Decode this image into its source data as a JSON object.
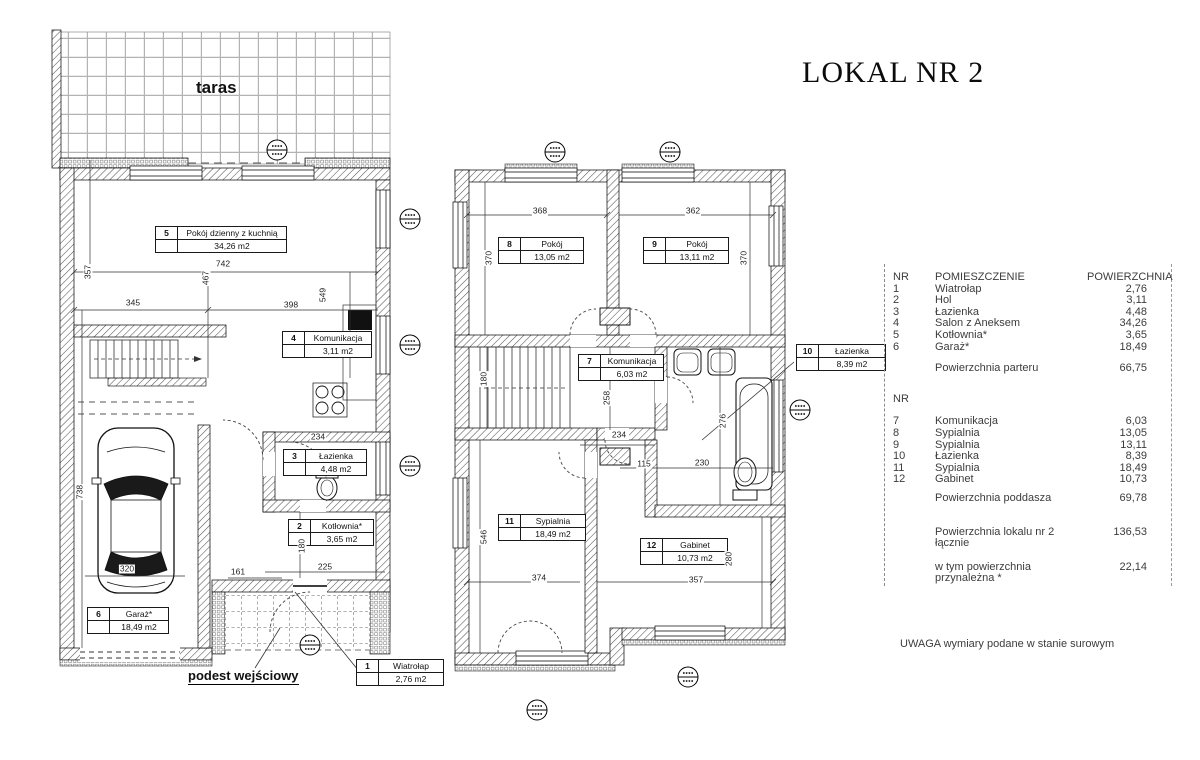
{
  "title": "LOKAL NR 2",
  "left_plan": {
    "terrace_label": "taras",
    "entry_label": "podest wejściowy",
    "rooms": [
      {
        "nr": "5",
        "name": "Pokój dzienny z kuchnią",
        "area": "34,26 m2",
        "x": 155,
        "y": 226,
        "w": 130
      },
      {
        "nr": "4",
        "name": "Komunikacja",
        "area": "3,11 m2",
        "x": 282,
        "y": 331,
        "w": 88
      },
      {
        "nr": "3",
        "name": "Łazienka",
        "area": "4,48 m2",
        "x": 283,
        "y": 449,
        "w": 82
      },
      {
        "nr": "2",
        "name": "Kotłownia*",
        "area": "3,65 m2",
        "x": 288,
        "y": 519,
        "w": 84
      },
      {
        "nr": "6",
        "name": "Garaż*",
        "area": "18,49 m2",
        "x": 87,
        "y": 607,
        "w": 80
      },
      {
        "nr": "1",
        "name": "Wiatrołap",
        "area": "2,76 m2",
        "x": 356,
        "y": 659,
        "w": 86
      }
    ],
    "dimensions": [
      {
        "v": "357",
        "x": 88,
        "y": 272,
        "rot": true
      },
      {
        "v": "742",
        "x": 223,
        "y": 264
      },
      {
        "v": "467",
        "x": 206,
        "y": 278,
        "rot": true
      },
      {
        "v": "345",
        "x": 133,
        "y": 303
      },
      {
        "v": "398",
        "x": 291,
        "y": 305
      },
      {
        "v": "549",
        "x": 323,
        "y": 295,
        "rot": true
      },
      {
        "v": "738",
        "x": 80,
        "y": 492,
        "rot": true
      },
      {
        "v": "320",
        "x": 127,
        "y": 569
      },
      {
        "v": "161",
        "x": 238,
        "y": 572
      },
      {
        "v": "225",
        "x": 325,
        "y": 567
      },
      {
        "v": "180",
        "x": 302,
        "y": 546,
        "rot": true
      },
      {
        "v": "234",
        "x": 318,
        "y": 437
      }
    ],
    "markers": [
      {
        "x": 277,
        "y": 150
      },
      {
        "x": 410,
        "y": 219
      },
      {
        "x": 410,
        "y": 345
      },
      {
        "x": 410,
        "y": 466
      },
      {
        "x": 310,
        "y": 645
      }
    ]
  },
  "right_plan": {
    "rooms": [
      {
        "nr": "8",
        "name": "Pokój",
        "area": "13,05 m2",
        "x": 498,
        "y": 237,
        "w": 84
      },
      {
        "nr": "9",
        "name": "Pokój",
        "area": "13,11 m2",
        "x": 643,
        "y": 237,
        "w": 84
      },
      {
        "nr": "7",
        "name": "Komunikacja",
        "area": "6,03 m2",
        "x": 578,
        "y": 354,
        "w": 84
      },
      {
        "nr": "10",
        "name": "Łazienka",
        "area": "8,39 m2",
        "x": 796,
        "y": 344,
        "w": 88
      },
      {
        "nr": "11",
        "name": "Sypialnia",
        "area": "18,49 m2",
        "x": 498,
        "y": 514,
        "w": 86
      },
      {
        "nr": "12",
        "name": "Gabinet",
        "area": "10,73 m2",
        "x": 640,
        "y": 538,
        "w": 86
      }
    ],
    "dimensions": [
      {
        "v": "368",
        "x": 540,
        "y": 211
      },
      {
        "v": "362",
        "x": 693,
        "y": 211
      },
      {
        "v": "370",
        "x": 489,
        "y": 258,
        "rot": true
      },
      {
        "v": "370",
        "x": 744,
        "y": 258,
        "rot": true
      },
      {
        "v": "180",
        "x": 484,
        "y": 379,
        "rot": true
      },
      {
        "v": "258",
        "x": 607,
        "y": 398,
        "rot": true
      },
      {
        "v": "234",
        "x": 619,
        "y": 435
      },
      {
        "v": "115",
        "x": 644,
        "y": 464
      },
      {
        "v": "230",
        "x": 702,
        "y": 463
      },
      {
        "v": "276",
        "x": 723,
        "y": 421,
        "rot": true
      },
      {
        "v": "546",
        "x": 484,
        "y": 537,
        "rot": true
      },
      {
        "v": "374",
        "x": 539,
        "y": 578
      },
      {
        "v": "357",
        "x": 696,
        "y": 580
      },
      {
        "v": "280",
        "x": 729,
        "y": 559,
        "rot": true
      }
    ],
    "markers": [
      {
        "x": 555,
        "y": 152
      },
      {
        "x": 670,
        "y": 152
      },
      {
        "x": 800,
        "y": 410
      },
      {
        "x": 537,
        "y": 710
      },
      {
        "x": 688,
        "y": 677
      }
    ]
  },
  "panel": {
    "col_nr": "NR",
    "col_nr2": "NR",
    "col_room": "POMIESZCZENIE",
    "col_area": "POWIERZCHNIA",
    "ground_rows": [
      [
        "1",
        "Wiatrołap",
        "2,76"
      ],
      [
        "2",
        "Hol",
        "3,11"
      ],
      [
        "3",
        "Łazienka",
        "4,48"
      ],
      [
        "4",
        "Salon z Aneksem",
        "34,26"
      ],
      [
        "5",
        "Kotłownia*",
        "3,65"
      ],
      [
        "6",
        "Garaż*",
        "18,49"
      ]
    ],
    "ground_total_label": "Powierzchnia parteru",
    "ground_total": "66,75",
    "upper_rows": [
      [
        "7",
        "Komunikacja",
        "6,03"
      ],
      [
        "8",
        "Sypialnia",
        "13,05"
      ],
      [
        "9",
        "Sypialnia",
        "13,11"
      ],
      [
        "10",
        "Łazienka",
        "8,39"
      ],
      [
        "11",
        "Sypialnia",
        "18,49"
      ],
      [
        "12",
        "Gabinet",
        "10,73"
      ]
    ],
    "upper_total_label": "Powierzchnia poddasza",
    "upper_total": "69,78",
    "total_label": "Powierzchnia lokalu nr 2 łącznie",
    "total": "136,53",
    "included_label": "w tym powierzchnia przynależna *",
    "included": "22,14",
    "note": "UWAGA wymiary podane w stanie surowym"
  }
}
